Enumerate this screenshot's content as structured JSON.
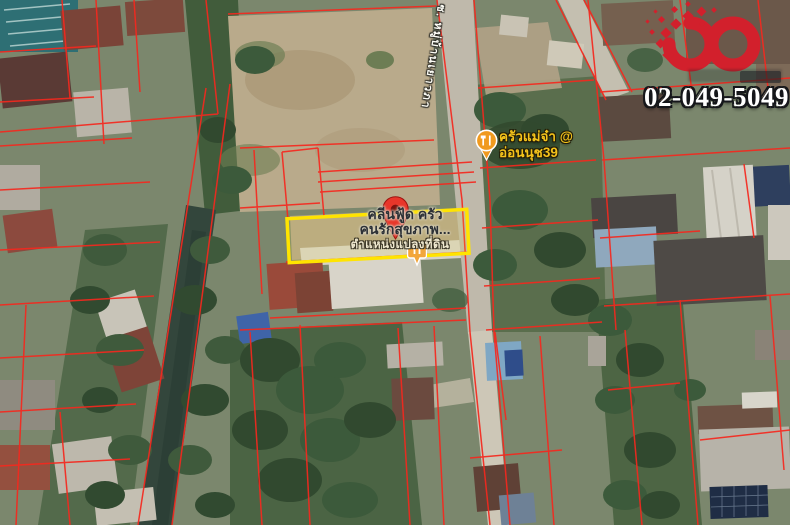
{
  "branding": {
    "phone_number": "02-049-5049",
    "logo_color": "#d2202c"
  },
  "map": {
    "road_label": "ซ. หมู่บ้านเยาวภา",
    "restaurant": {
      "label_line1": "ครัวแม่จ๋า @",
      "label_line2": "อ่อนนุช39"
    },
    "plot": {
      "label_line1": "คลีนฟู้ด ครัว",
      "label_line2": "คนรักสุขภาพ...",
      "position_label": "ตำแหน่งแปลงที่ดิน"
    },
    "colors": {
      "highlight": "#ffe400",
      "parcel_line": "#f5281e",
      "pin": "#e8362a",
      "poi": "#f09a1f"
    }
  }
}
